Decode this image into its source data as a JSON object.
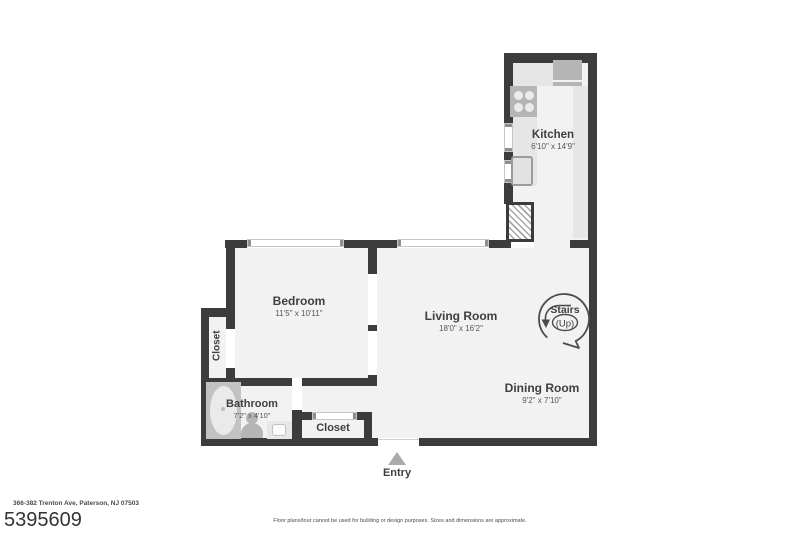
{
  "rooms": {
    "kitchen": {
      "name": "Kitchen",
      "dims": "6'10\" x 14'9\""
    },
    "bedroom": {
      "name": "Bedroom",
      "dims": "11'5\" x 10'11\""
    },
    "living_room": {
      "name": "Living Room",
      "dims": "18'0\" x 16'2\""
    },
    "dining_room": {
      "name": "Dining Room",
      "dims": "9'2\" x 7'10\""
    },
    "bathroom": {
      "name": "Bathroom",
      "dims": "7'2\" x 4'10\""
    },
    "closet_left": {
      "name": "Closet"
    },
    "closet_entry": {
      "name": "Closet"
    }
  },
  "labels": {
    "stairs_line1": "Stairs",
    "stairs_line2": "(Up)",
    "entry": "Entry"
  },
  "footer": {
    "address": "366-382 Trenton Ave, Paterson, NJ 07503",
    "mls_number": "5395609",
    "disclaimer": "Floor plans/tour cannot be used for building or design purposes. Sizes and dimensions are approximate."
  },
  "colors": {
    "wall": "#3c3c3c",
    "floor": "#f2f2f2",
    "counter": "#e6e6e6",
    "appliance": "#b5b5b5",
    "text": "#3f3f3f"
  }
}
